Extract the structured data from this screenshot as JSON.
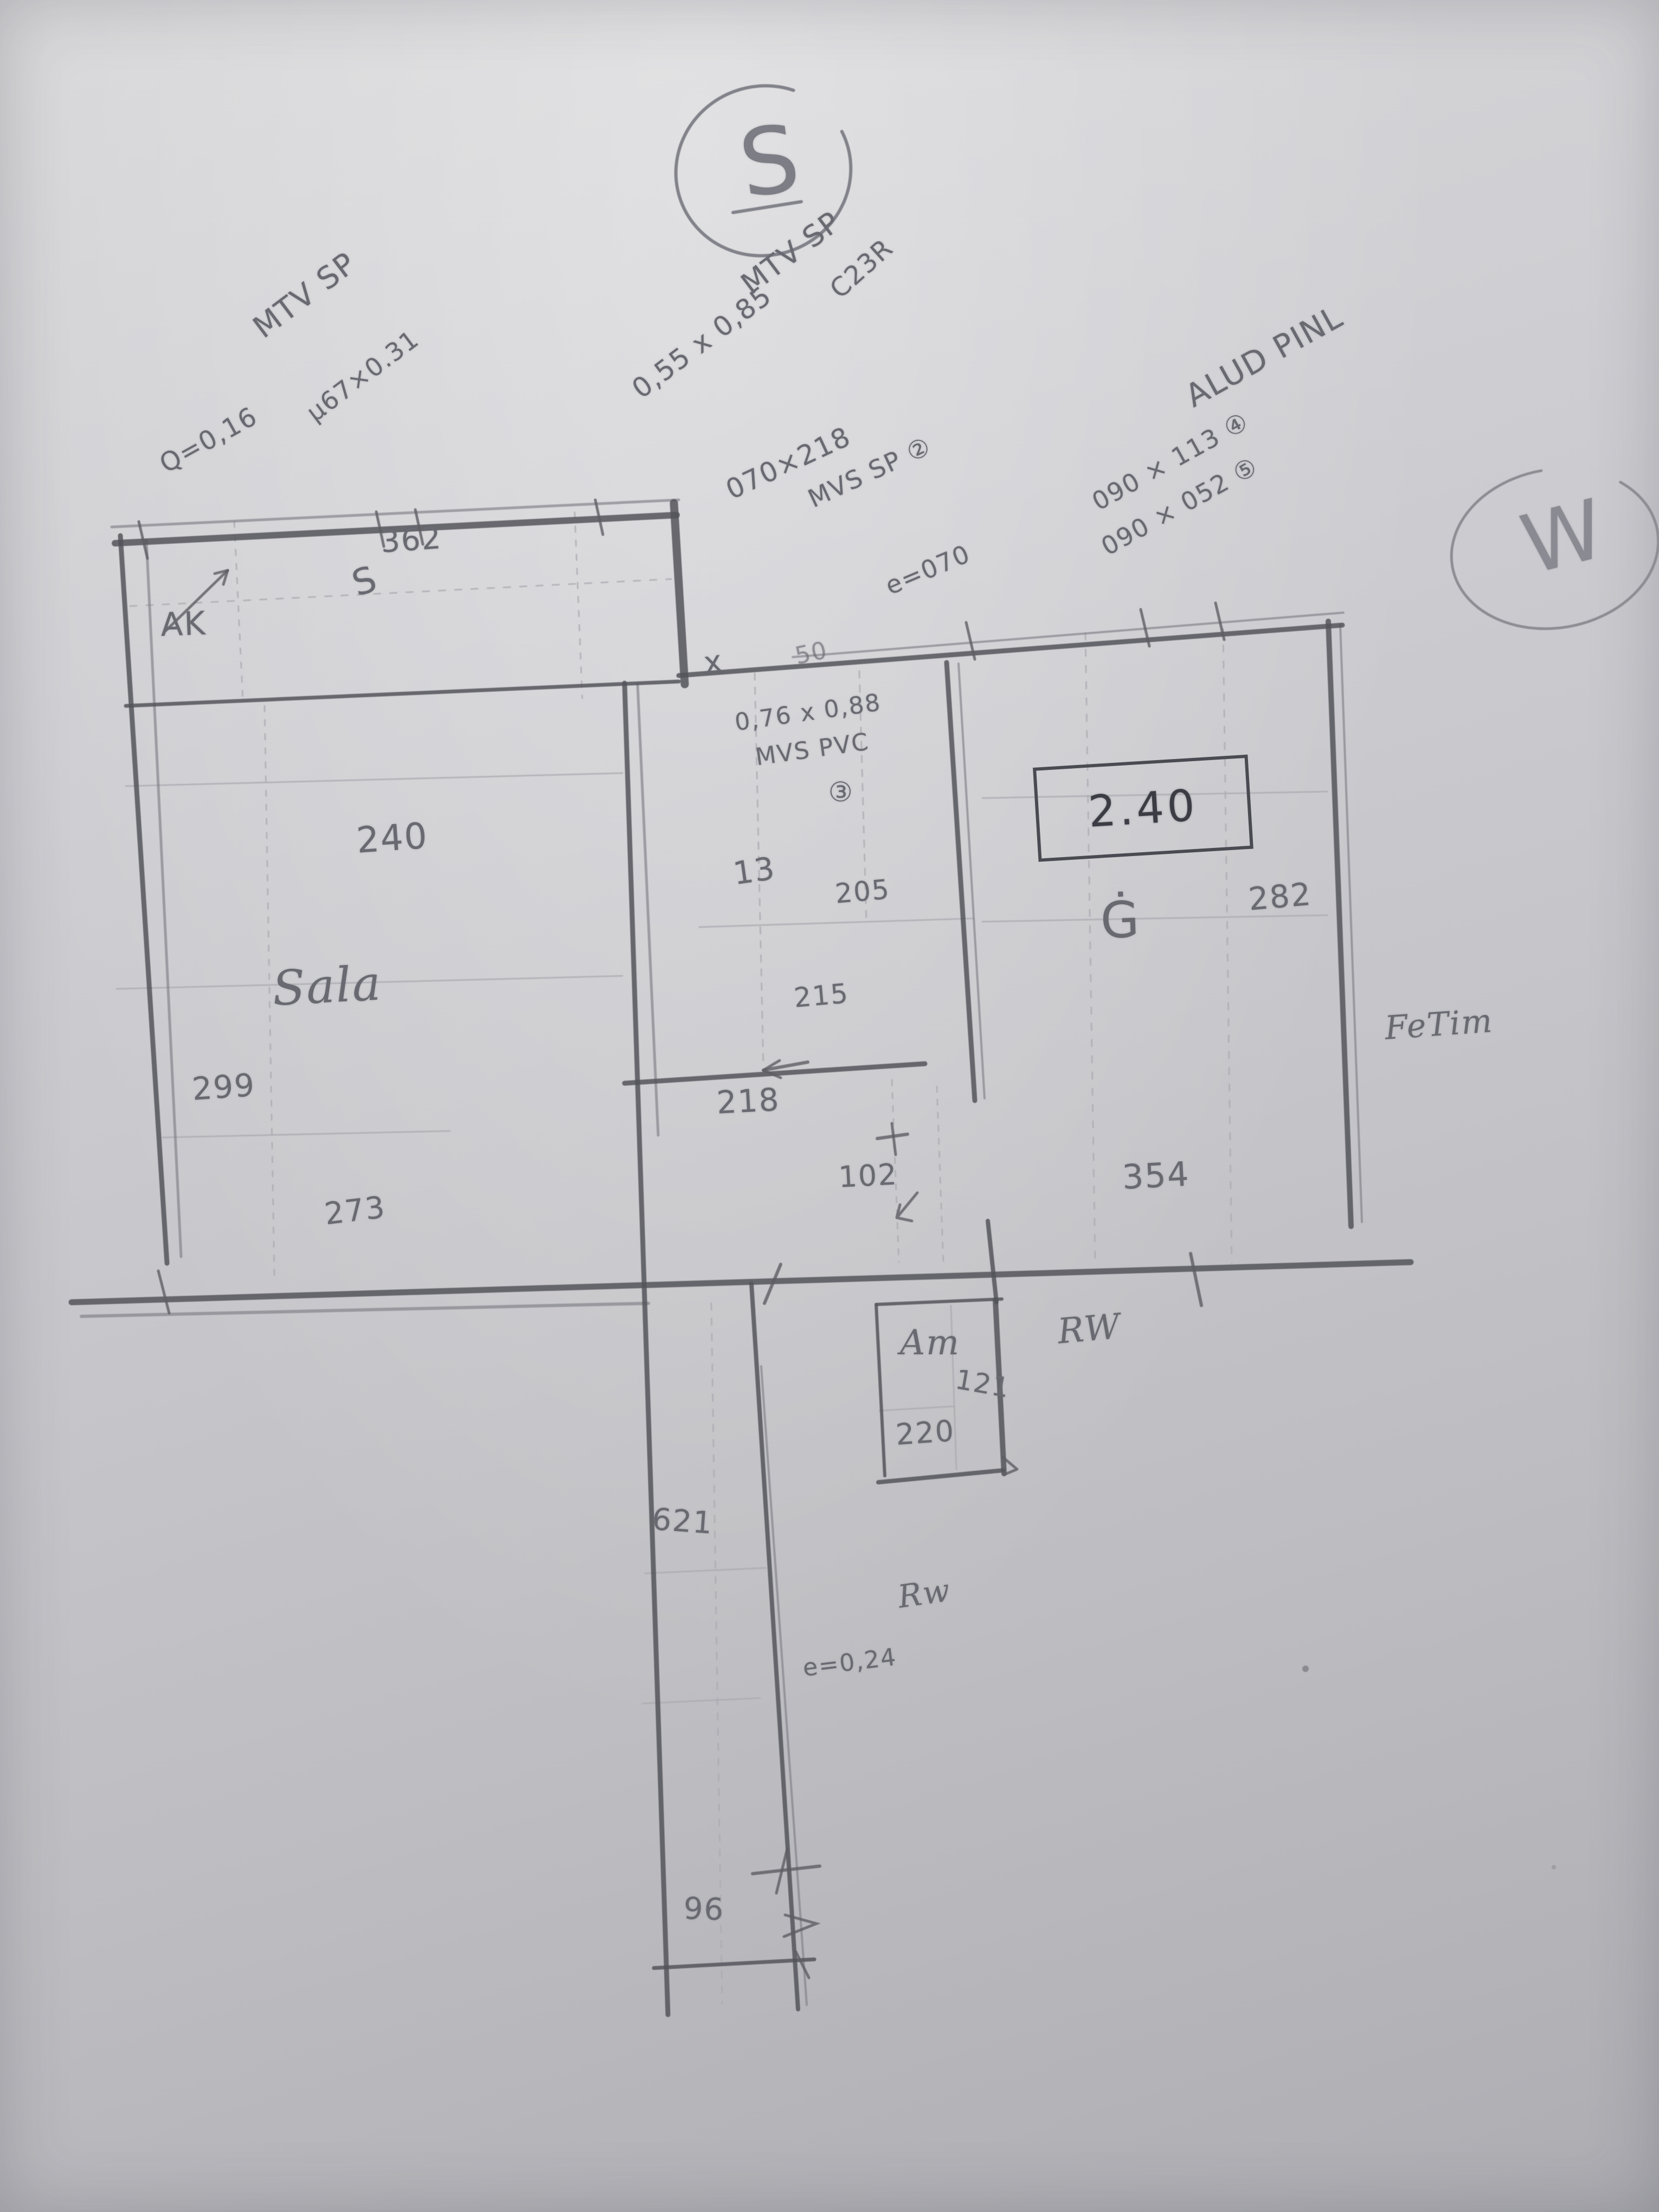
{
  "compass": {
    "south": "S",
    "west": "W"
  },
  "notes": {
    "mtv1": {
      "title": "MTV SP",
      "q": "Q=0,16",
      "size": "µ67×0.31"
    },
    "mtv2": {
      "title": "MTV SP",
      "size": "0,55 x 0,85",
      "note": "C23R"
    },
    "mvs_sp": {
      "size": "070×218",
      "title": "MVS SP ②",
      "e": "e=070"
    },
    "alum": {
      "title": "ALUD PINL",
      "size1": "090 × 113 ④",
      "size2": "090 × 052 ⑤"
    },
    "mvs_pvc": {
      "size": "0,76 x 0,88",
      "title": "MVS PVC",
      "mark": "③"
    },
    "fetim": "FeTim",
    "rw_upper": "RW",
    "rw_lower": "Rw",
    "mark_x": "x",
    "mark_50": "50"
  },
  "strip": {
    "dim_width": "362",
    "label": "AK",
    "mark": "S"
  },
  "sala": {
    "name": "Sala",
    "dim": "240",
    "dim_left": "299",
    "dim_bottom": "273"
  },
  "middle_room": {
    "label": "13",
    "dim_a": "205",
    "dim_b": "215",
    "dim_bottom": "218"
  },
  "right_room": {
    "boxed_height": "2.40",
    "mark": "Ġ",
    "dim_right": "282",
    "dim_bottom": "354"
  },
  "hall": {
    "dim": "102"
  },
  "am_room": {
    "name": "Am",
    "dim_right": "121",
    "dim_bottom": "220"
  },
  "corridor": {
    "dim_top": "621",
    "tick_note": "e=0,24",
    "dim_bottom": "96"
  }
}
